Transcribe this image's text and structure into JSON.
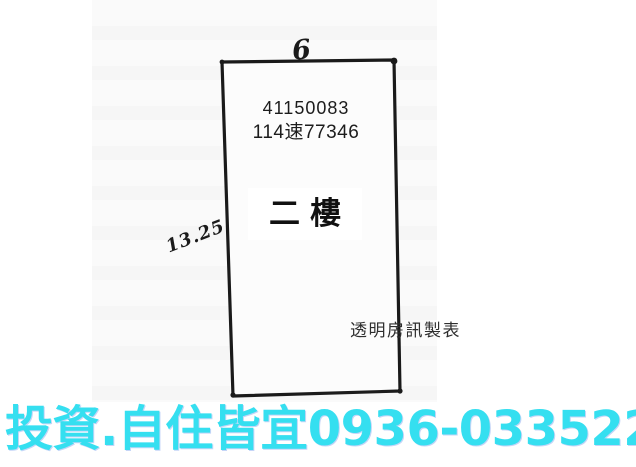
{
  "plan": {
    "parcel_number": "41150083",
    "file_number": "114速77346",
    "floor_label": "二樓",
    "top_dimension": "6",
    "left_dimension": "13.25",
    "watermark": "透明房訊製表",
    "ink_color": "#1a1a1a"
  },
  "banner": {
    "slogan": "投資.自住皆宜",
    "phone": "0936-033522",
    "color": "#35dff0",
    "shadow_color": "#5a86e8"
  }
}
